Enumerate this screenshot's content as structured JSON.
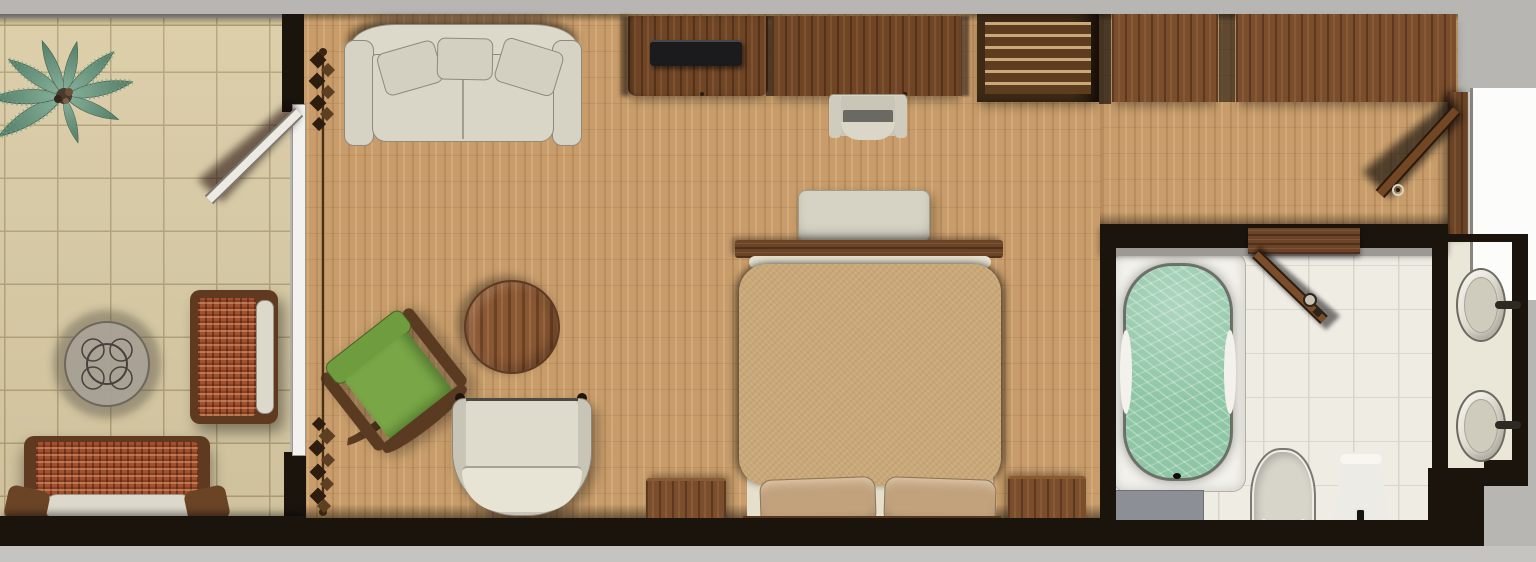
{
  "title": "Resort guest-room floor plan (top-down 3D render, no text labels)",
  "scene": {
    "background": "#b8b6b3",
    "rooms": [
      {
        "id": "terrace",
        "label": "tiled terrace",
        "furniture": [
          "palm-plant",
          "round-glass-wicker-table",
          "wicker-armchair-with-white-cushion",
          "wicker-sofa-with-white-cushion"
        ],
        "doors": [
          "terrace-hinged-door-open"
        ]
      },
      {
        "id": "bedroom",
        "label": "bedroom / living area",
        "furniture": [
          "cream-sofa-with-three-pillows",
          "tv-console-with-flatscreen-tv",
          "writing-desk",
          "desk-chair",
          "slatted-shelf-unit",
          "wardrobe-left",
          "wardrobe-right",
          "green-lounge-chair",
          "bentwood-ottoman",
          "round-wood-coffee-table",
          "cream-tub-chair",
          "double-bed",
          "bed-bench",
          "bed-footboard-shelf",
          "pillow-left",
          "pillow-right",
          "nightstand-left",
          "nightstand-right",
          "curtain-on-rod"
        ],
        "doors": [
          "sliding-glass-door-to-terrace",
          "entry-door-open"
        ]
      },
      {
        "id": "bathroom",
        "label": "bathroom",
        "furniture": [
          "bathtub-filled-with-water",
          "bath-mat",
          "toilet",
          "bidet"
        ],
        "doors": [
          "bathroom-door-open"
        ]
      },
      {
        "id": "vanity",
        "label": "vanity alcove",
        "furniture": [
          "round-sink-top",
          "round-sink-bottom",
          "faucet-top",
          "faucet-bottom"
        ]
      }
    ]
  },
  "palette": {
    "background_gray": "#b8b6b3",
    "bottom_strip": "#c6c4c1",
    "wall_dark": "#1a140d",
    "tile_floor": "#d9cba4",
    "wood_floor": "#c89d6b",
    "bath_floor": "#efece4",
    "vanity_floor": "#ebe7d8",
    "furniture_wood": "#6f4526",
    "wardrobe_wood": "#7a4e2c",
    "frame_wood": "#5b3a22",
    "cream_upholstery": "#d9d5c7",
    "wicker": "#a2502e",
    "bed_spread": "#c9a878",
    "pillow": "#c1a27d",
    "green_chair": "#6f9c3f",
    "water": "#8fc6a6",
    "tub_white": "#f3f1eb",
    "porcelain": "#d7d4c9",
    "tv_black": "#1b1b1d",
    "exterior_white": "#fcfcfa",
    "mat_gray": "#8d8f96"
  }
}
